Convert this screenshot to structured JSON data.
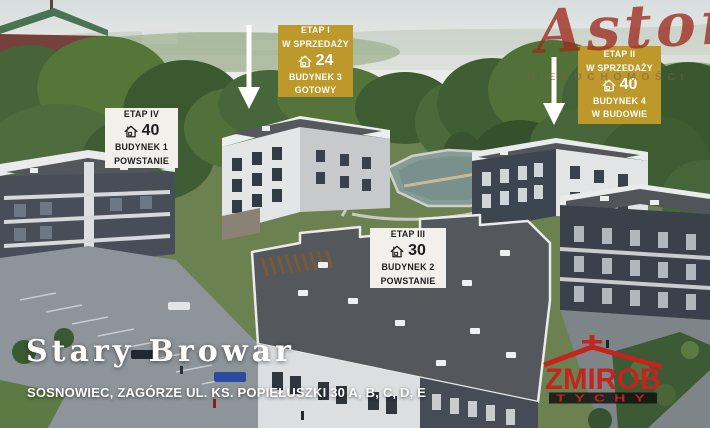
{
  "watermark": {
    "brand": "Aston",
    "subtitle": "NIERUCHOMOŚCI"
  },
  "callouts": {
    "etap1": {
      "stage": "ETAP I",
      "sale": "W SPRZEDAŻY",
      "units": "24",
      "building": "BUDYNEK 3",
      "status": "GOTOWY"
    },
    "etap2": {
      "stage": "ETAP II",
      "sale": "W SPRZEDAŻY",
      "units": "40",
      "building": "BUDYNEK 4",
      "status": "W BUDOWIE"
    },
    "etap3": {
      "stage": "ETAP III",
      "units": "30",
      "building": "BUDYNEK 2",
      "status": "POWSTANIE"
    },
    "etap4": {
      "stage": "ETAP IV",
      "units": "40",
      "building": "BUDYNEK 1",
      "status": "POWSTANIE"
    }
  },
  "footer": {
    "project": "Stary Browar",
    "address": "SOSNOWIEC, ZAGÓRZE UL. KS. POPIEŁUSZKI 30 A, B, C, D, E"
  },
  "logo": {
    "name": "ZMIROB",
    "city": "TYCHY"
  },
  "colors": {
    "callout_gold": "#BD992C",
    "callout_light": "#F2F0EA",
    "callout_dark_text": "#1D1D1D",
    "logo_red": "#C3241E",
    "watermark_red": "#9E2A1E",
    "arrow_white": "#FFFFFF"
  },
  "icons": {
    "house_icon": "⌂",
    "arrow_down_icon": "↓"
  }
}
